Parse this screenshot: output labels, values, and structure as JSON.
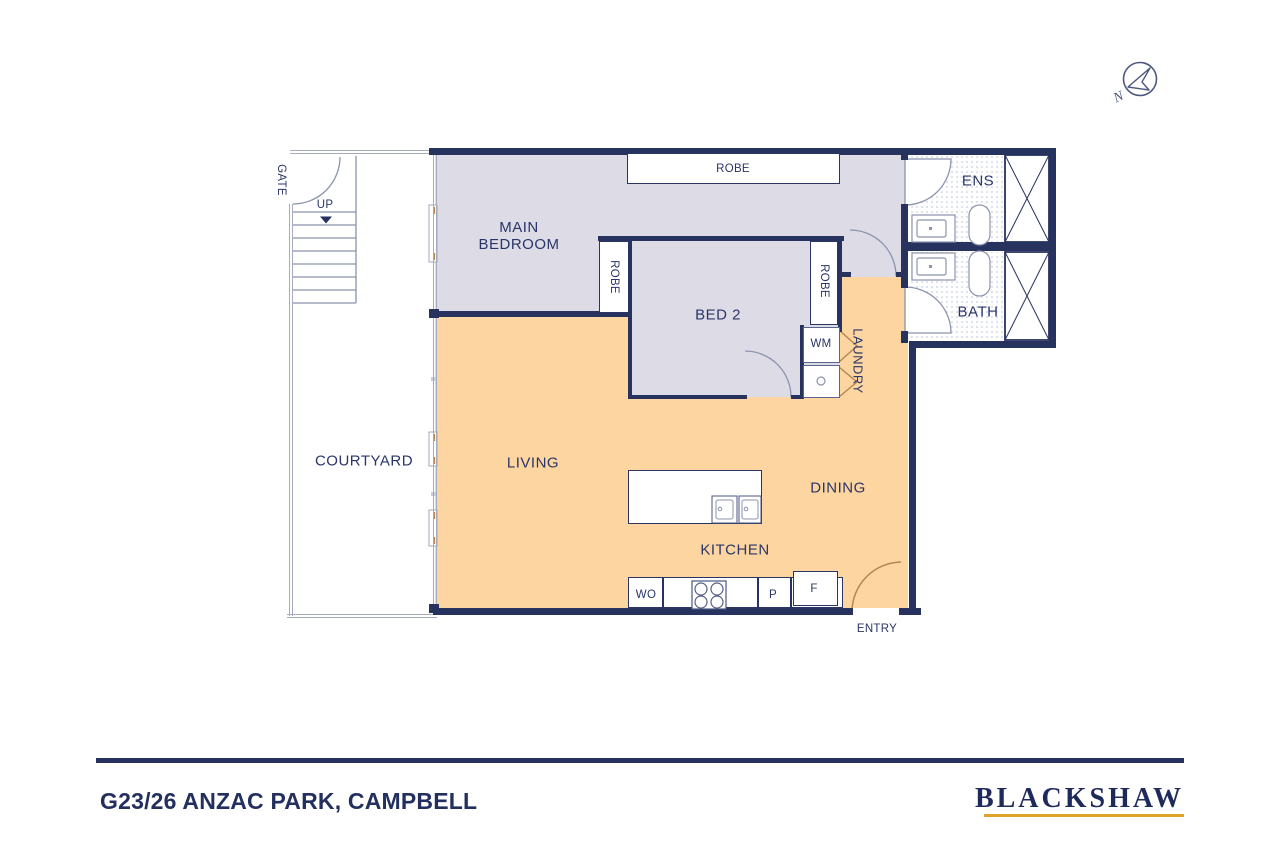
{
  "footer": {
    "address": "G23/26 ANZAC PARK, CAMPBELL",
    "brand": "BLACKSHAW"
  },
  "compass": {
    "north": "N"
  },
  "rooms": {
    "main_bedroom_line1": "MAIN",
    "main_bedroom_line2": "BEDROOM",
    "bed2": "BED 2",
    "living": "LIVING",
    "dining": "DINING",
    "kitchen": "KITCHEN",
    "courtyard": "COURTYARD",
    "laundry": "LAUNDRY",
    "ens": "ENS",
    "bath": "BATH"
  },
  "labels": {
    "robe_top": "ROBE",
    "robe_main": "ROBE",
    "robe_bed2": "ROBE",
    "gate": "GATE",
    "up": "UP",
    "entry": "ENTRY",
    "washing_machine": "WM",
    "wall_oven": "WO",
    "pantry": "P",
    "fridge": "F"
  },
  "colors": {
    "wall_navy": "#27325f",
    "bedroom_fill": "#dcdbe6",
    "living_fill": "#fdd5a0",
    "line_grey": "#8b93ad",
    "door_tan": "#b5854f",
    "logo_gold": "#dfa32b",
    "text_navy": "#2b3568",
    "tile_dot": "#c6cee0"
  }
}
